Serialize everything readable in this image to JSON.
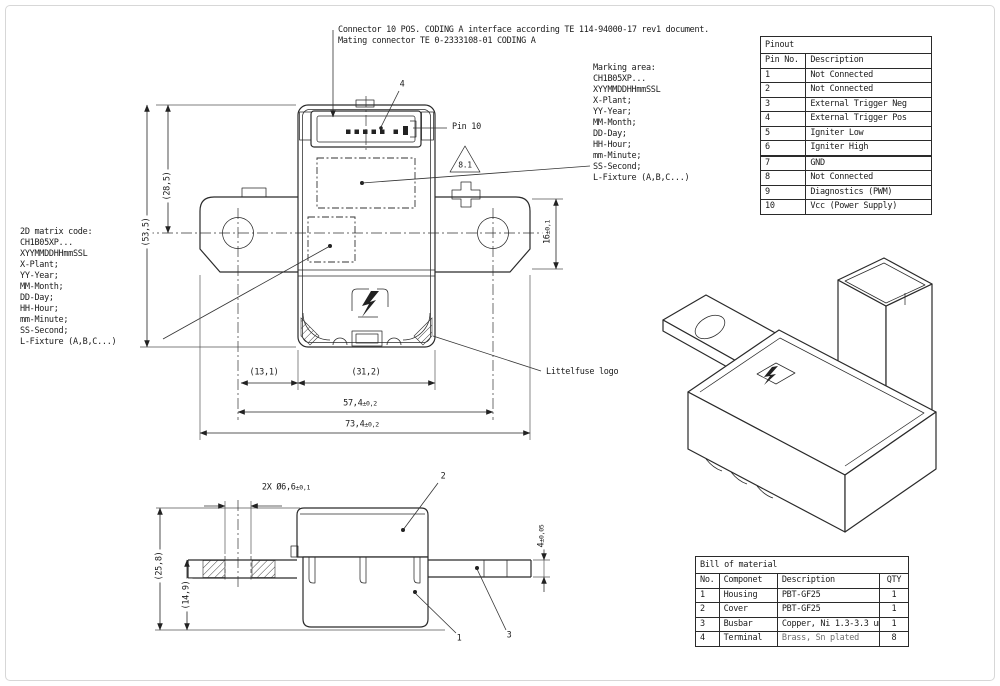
{
  "annotations": {
    "connector_note_line1": "Connector 10 POS. CODING A interface according TE 114-94000-17 rev1 document.",
    "connector_note_line2": "Mating connector TE 0-2333108-01 CODING A",
    "marking_area": {
      "title": "Marking area:",
      "lines": [
        "CH1B05XP...",
        "XYYMMDDHHmmSSL",
        "X-Plant;",
        "YY-Year;",
        "MM-Month;",
        "DD-Day;",
        "HH-Hour;",
        "mm-Minute;",
        "SS-Second;",
        "L-Fixture (A,B,C...)"
      ]
    },
    "matrix_code": {
      "title": "2D matrix code:",
      "lines": [
        "CH1B05XP...",
        "XYYMMDDHHmmSSL",
        "X-Plant;",
        "YY-Year;",
        "MM-Month;",
        "DD-Day;",
        "HH-Hour;",
        "mm-Minute;",
        "SS-Second;",
        "L-Fixture (A,B,C...)"
      ]
    },
    "pin10": "Pin 10",
    "callout_connector": "4",
    "warning_ref": "8.1",
    "logo_label": "Littelfuse logo",
    "callout_housing": "1",
    "callout_cover": "2",
    "callout_busbar": "3"
  },
  "dimensions": {
    "front": {
      "height_upper": "(28,5)",
      "height_overall": "(53,5)",
      "tab_height": {
        "v": "16",
        "t": "±0,1"
      },
      "edge_offset": "(13,1)",
      "body_width": "(31,2)",
      "hole_pitch": {
        "v": "57,4",
        "t": "±0,2"
      },
      "overall_width": {
        "v": "73,4",
        "t": "±0,2"
      }
    },
    "side": {
      "hole_dia": {
        "prefix": "2X",
        "v": "Ø6,6",
        "t": "±0,1"
      },
      "height_overall": "(25,8)",
      "height_lower": "(14,9)",
      "busbar_thickness": {
        "v": "4",
        "t": "±0,05"
      }
    }
  },
  "pinout_table": {
    "title": "Pinout",
    "columns": [
      "Pin No.",
      "Description"
    ],
    "rows": [
      [
        "1",
        "Not Connected"
      ],
      [
        "2",
        "Not Connected"
      ],
      [
        "3",
        "External Trigger Neg"
      ],
      [
        "4",
        "External Trigger Pos"
      ],
      [
        "5",
        "Igniter Low"
      ],
      [
        "6",
        "Igniter High"
      ],
      [
        "7",
        "GND"
      ],
      [
        "8",
        "Not Connected"
      ],
      [
        "9",
        "Diagnostics (PWM)"
      ],
      [
        "10",
        "Vcc (Power Supply)"
      ]
    ]
  },
  "bom_table": {
    "title": "Bill of material",
    "columns": [
      "No.",
      "Componet",
      "Description",
      "QTY"
    ],
    "rows": [
      [
        "1",
        "Housing",
        "PBT-GF25",
        "1"
      ],
      [
        "2",
        "Cover",
        "PBT-GF25",
        "1"
      ],
      [
        "3",
        "Busbar",
        "Copper, Ni 1.3-3.3 um",
        "1"
      ],
      [
        "4",
        "Terminal",
        "Brass, Sn plated",
        "8"
      ]
    ]
  }
}
